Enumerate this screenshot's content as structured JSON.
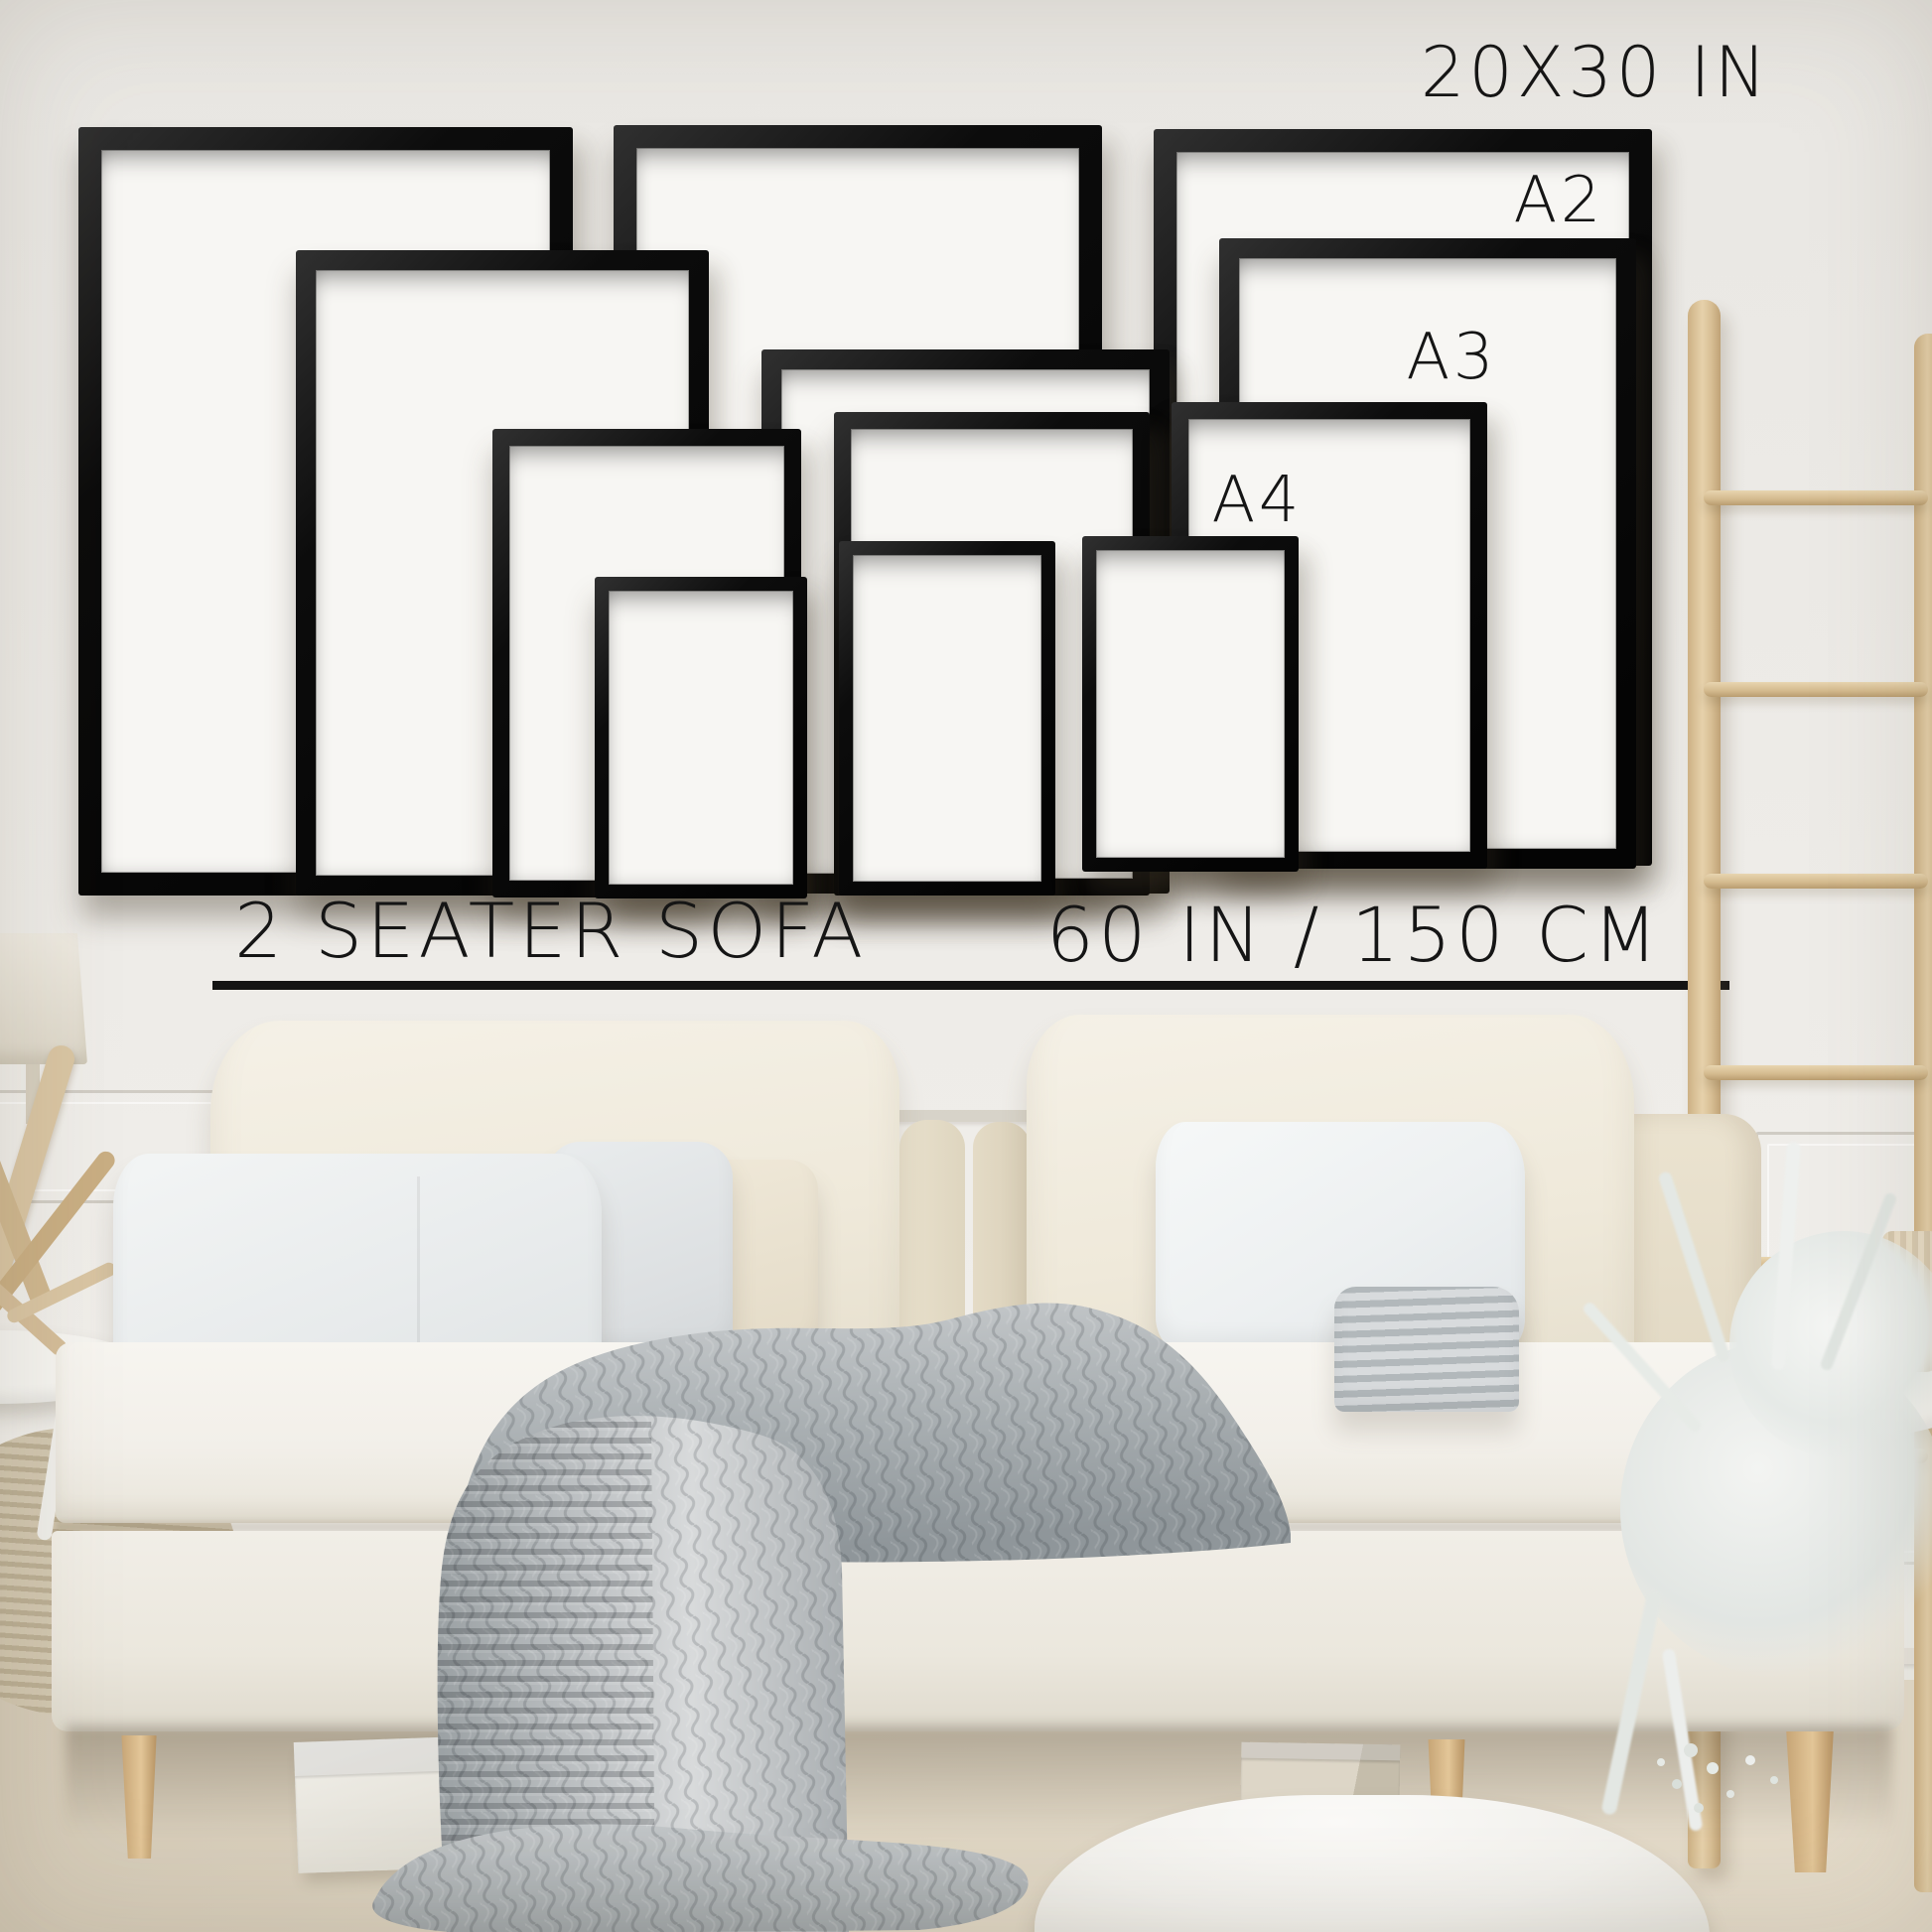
{
  "image": {
    "kind": "wall art size guide photo",
    "wall_text": {
      "size_20x30": "20X30 IN",
      "size_a2": "A2",
      "size_a3": "A3",
      "size_a4": "A4",
      "sofa_label": "2 SEATER SOFA",
      "sofa_width": "60 IN / 150 CM"
    },
    "frames": [
      {
        "size": "20X30 IN",
        "position": "left"
      },
      {
        "size": "20X30 IN",
        "position": "middle"
      },
      {
        "size": "20X30 IN",
        "position": "right"
      },
      {
        "size": "A2",
        "position": "left"
      },
      {
        "size": "A2",
        "position": "middle"
      },
      {
        "size": "A2",
        "position": "right"
      },
      {
        "size": "A3",
        "position": "left"
      },
      {
        "size": "A3",
        "position": "middle"
      },
      {
        "size": "A3",
        "position": "right"
      },
      {
        "size": "A4",
        "position": "left"
      },
      {
        "size": "A4",
        "position": "middle"
      },
      {
        "size": "A4",
        "position": "right"
      }
    ],
    "colors": {
      "wall": "#edebe7",
      "frame_black": "#0d0d0d",
      "frame_mat": "#f7f6f3",
      "text": "#151515",
      "sofa_cream": "#f1ede3",
      "cushion_cream": "#ece5d6",
      "pillow_white": "#eef1f2",
      "blanket_gray": "#aab0b3",
      "ladder_wood": "#e0c9a4",
      "carpet": "#dbd2c0",
      "plant_white": "#e7ebe7"
    },
    "scene_objects": [
      "picture frames",
      "two seater sofa",
      "back cushions",
      "throw pillows",
      "knit throw blanket",
      "wooden ladder",
      "white eucalyptus plant",
      "round side tables",
      "table lamp",
      "driftwood sculpture",
      "storage boxes",
      "floor pouf",
      "wall panel molding"
    ]
  }
}
